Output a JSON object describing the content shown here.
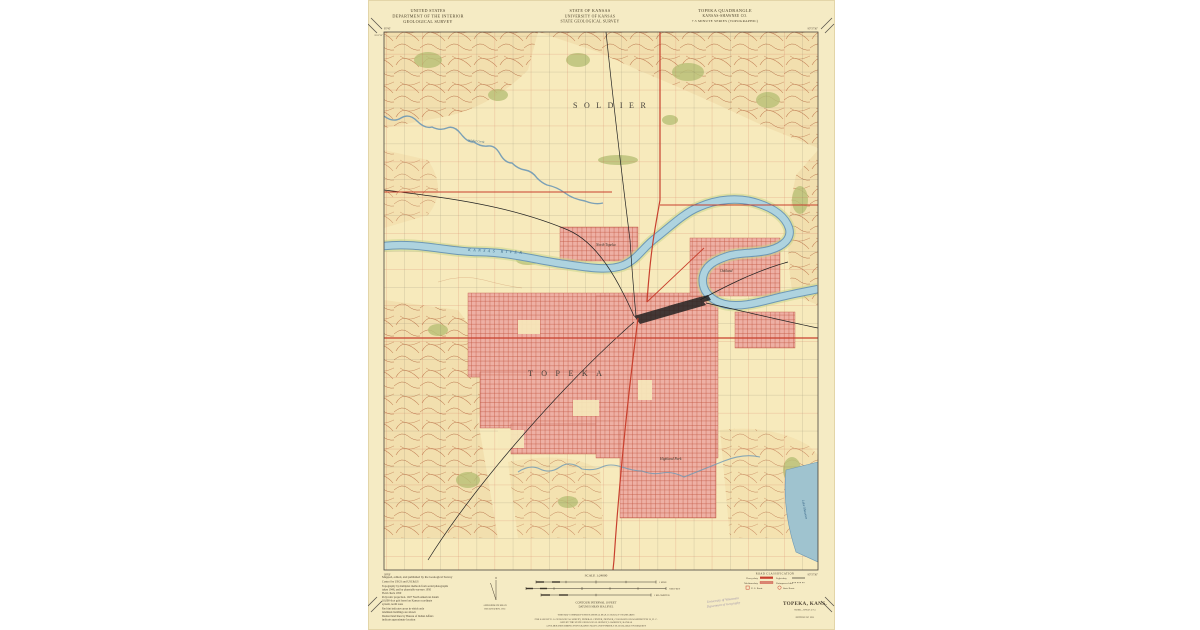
{
  "colors": {
    "paper": "#f5ebc4",
    "map_background": "#f7eabc",
    "urban_tint": "#eeb0a4",
    "urban_grid_red": "#c25843",
    "water_fill": "#aed3df",
    "water_edge": "#6d98b5",
    "contour_brown": "#c07a50",
    "vegetation_green": "#b9c178",
    "highway_red": "#c8402e",
    "grid_black": "#3f3f38",
    "stamp_purple": "#8f84a6"
  },
  "header": {
    "left": [
      "UNITED STATES",
      "DEPARTMENT OF THE INTERIOR",
      "GEOLOGICAL SURVEY"
    ],
    "center": [
      "STATE OF KANSAS",
      "UNIVERSITY OF KANSAS",
      "STATE GEOLOGICAL SURVEY"
    ],
    "right": [
      "TOPEKA QUADRANGLE",
      "KANSAS-SHAWNEE CO.",
      "7.5 MINUTE SERIES (TOPOGRAPHIC)"
    ]
  },
  "map": {
    "labels": {
      "township": "SOLDIER",
      "city": "TOPEKA",
      "river": "KANSAS RIVER",
      "creek": "Soldier Creek",
      "north_topeka": "North Topeka",
      "oakland": "Oakland",
      "highland_park": "Highland Park",
      "lake": "Lake Shawnee"
    },
    "corners": {
      "nw_lon": "95°45'",
      "nw_lat": "39°07'30\"",
      "ne_lon": "95°37'30\"",
      "sw_lat": "39°00'",
      "se_lon": "95°37'30\""
    }
  },
  "footer": {
    "credits": [
      "Mapped, edited, and published by the Geological Survey",
      "Control by USGS and USC&GS",
      "Topography by multiplex methods from aerial photographs",
      "taken 1948, and by planetable surveys 1950",
      "Field check 1950",
      "Polyconic projection.  1927 North American datum",
      "10,000-foot grid based on Kansas coordinate",
      "system, north zone",
      "Red tint indicates areas in which only",
      "landmark buildings are shown",
      "Dashed land lines by Bureau of Indian Affairs",
      "indicate approximate location"
    ],
    "declination": [
      "APPROXIMATE MEAN",
      "DECLINATION, 1951"
    ],
    "scale": {
      "title": "SCALE 1:24000",
      "bar_labels": [
        "1 MILE",
        "7000 FEET",
        "1 KILOMETER"
      ],
      "contour": "CONTOUR INTERVAL 10 FEET",
      "datum": "DATUM IS MEAN SEA LEVEL",
      "accuracy": "THIS MAP COMPLIES WITH NATIONAL MAP ACCURACY STANDARDS",
      "sale": [
        "FOR SALE BY U. S. GEOLOGICAL SURVEY, FEDERAL CENTER, DENVER, COLORADO OR WASHINGTON 25, D. C.",
        "AND BY THE STATE GEOLOGICAL SURVEY, LAWRENCE, KANSAS",
        "A FOLDER DESCRIBING TOPOGRAPHIC MAPS AND SYMBOLS IS AVAILABLE ON REQUEST"
      ]
    },
    "stamp": [
      "University of Wisconsin",
      "Department of Geography"
    ],
    "roads": {
      "title": "ROAD CLASSIFICATION",
      "heavy": "Heavy-duty",
      "medium": "Medium-duty",
      "light": "Light-duty",
      "unimproved": "Unimproved dirt",
      "us_route": "U. S. Route",
      "state_route": "State Route"
    },
    "title_block": {
      "name": "TOPEKA, KANS.",
      "code": "N3900—W9537.5/7.5",
      "edition": "EDITION OF 1951"
    }
  }
}
